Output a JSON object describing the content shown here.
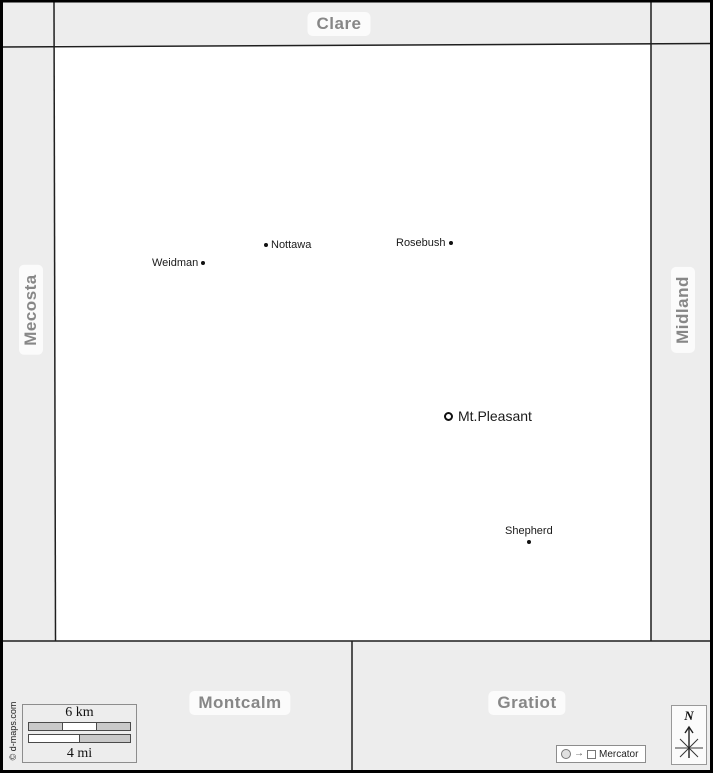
{
  "colors": {
    "band_bg": "#ededed",
    "map_bg": "#ffffff",
    "county_label_text": "#878787",
    "boundary_line": "#1f1f1f",
    "city_text": "#1a1a1a"
  },
  "counties": {
    "north": "Clare",
    "west": "Mecosta",
    "east": "Midland",
    "southwest": "Montcalm",
    "southeast": "Gratiot"
  },
  "cities": [
    {
      "name": "Weidman",
      "marker": "dot-right"
    },
    {
      "name": "Nottawa",
      "marker": "dot-left"
    },
    {
      "name": "Rosebush",
      "marker": "dot-right"
    },
    {
      "name": "Mt.Pleasant",
      "marker": "ring-left"
    },
    {
      "name": "Shepherd",
      "marker": "dot-below"
    }
  ],
  "scale_bar": {
    "km": "6 km",
    "mi": "4 mi"
  },
  "compass": {
    "label": "N"
  },
  "projection": {
    "label": "Mercator"
  },
  "credit": "© d-maps.com"
}
